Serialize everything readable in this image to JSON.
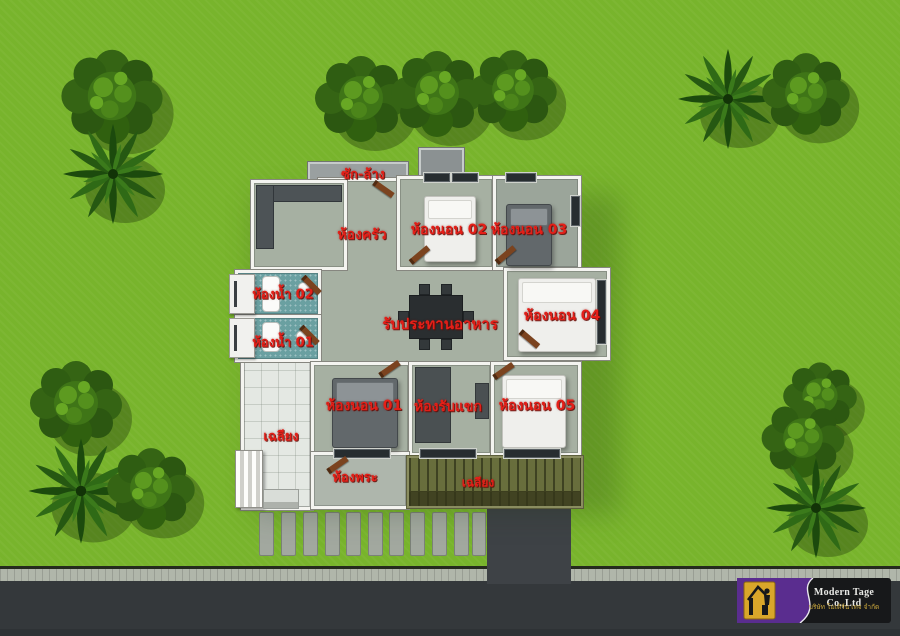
{
  "plan": {
    "labels": {
      "washing": "ซัก-ล้าง",
      "kitchen": "ห้องครัว",
      "bedroom2": "ห้องนอน 02",
      "bedroom3": "ห้องนอน 03",
      "bathroom2": "ห้องน้ำ 02",
      "bathroom1": "ห้องน้ำ 01",
      "dining": "รับประทานอาหาร",
      "bedroom4": "ห้องนอน 04",
      "porch_left": "เฉลียง",
      "bedroom1": "ห้องนอน 01",
      "living": "ห้องรับแขก",
      "bedroom5": "ห้องนอน 05",
      "prayer": "ห้องพระ",
      "porch_bottom": "เฉลียง"
    }
  },
  "branding": {
    "company": "Modern Tage Co.,Ltd",
    "company_thai": "บริษัท โมเดิร์น เทจ จำกัด"
  },
  "scene": {
    "round_trees": 9,
    "palm_trees": 4
  },
  "colors": {
    "grass": "#78b42c",
    "wall": "#f4f4f0",
    "floor": "#a6b0a2",
    "bath_floor": "#6aa0a1",
    "label_red": "#e41f18",
    "road_asphalt": "#34383b",
    "curb": "#b0b6aa",
    "logo_purple": "#5a2d8f",
    "logo_gold": "#d9a62a"
  }
}
